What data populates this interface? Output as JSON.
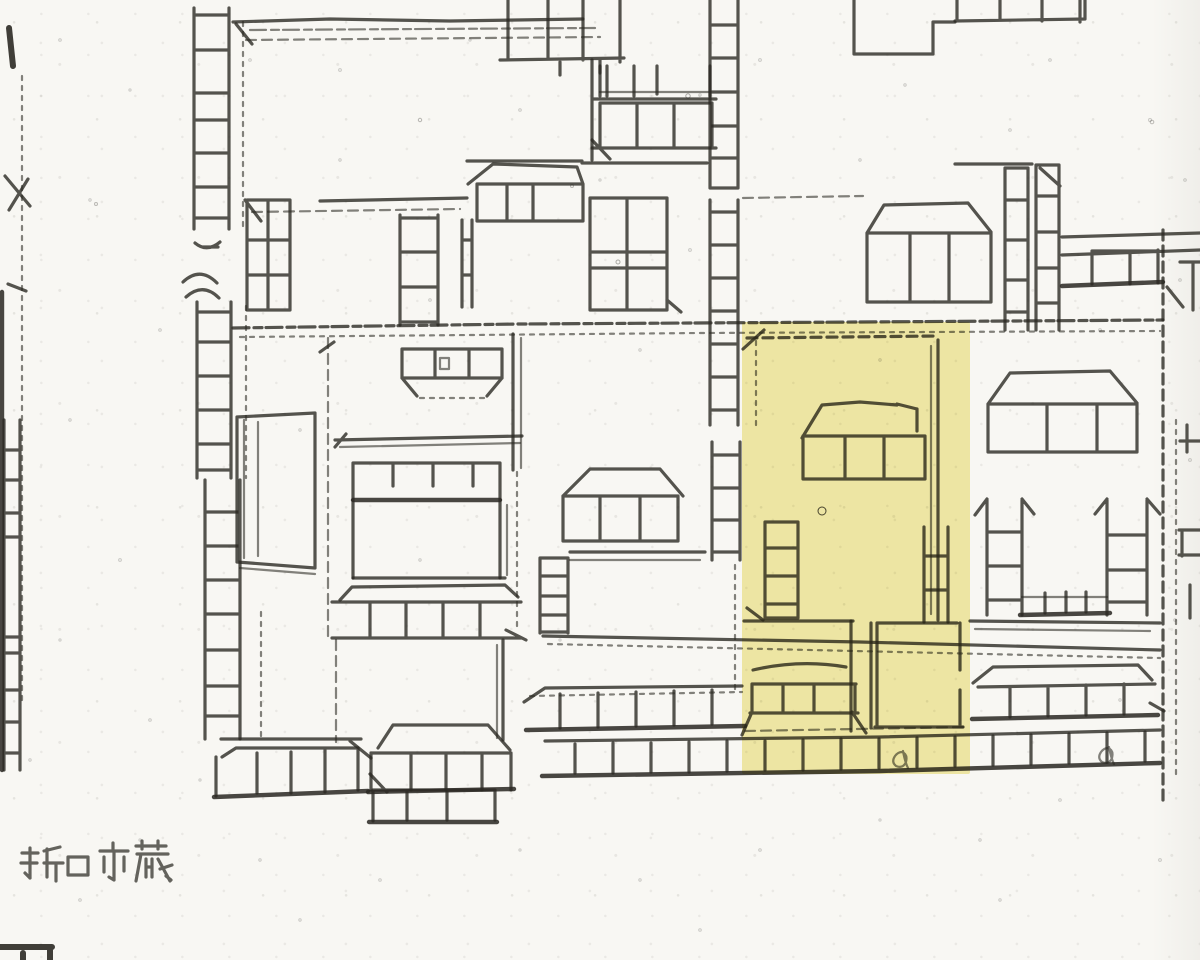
{
  "map": {
    "owner_label": "折口市蔵",
    "highlight": {
      "color": "#f1e998",
      "opacity": 0.82,
      "x": 742,
      "y": 322,
      "width": 228,
      "height": 452
    },
    "ink_color": "#2b2923",
    "paper_color": "#f8f7f3"
  }
}
